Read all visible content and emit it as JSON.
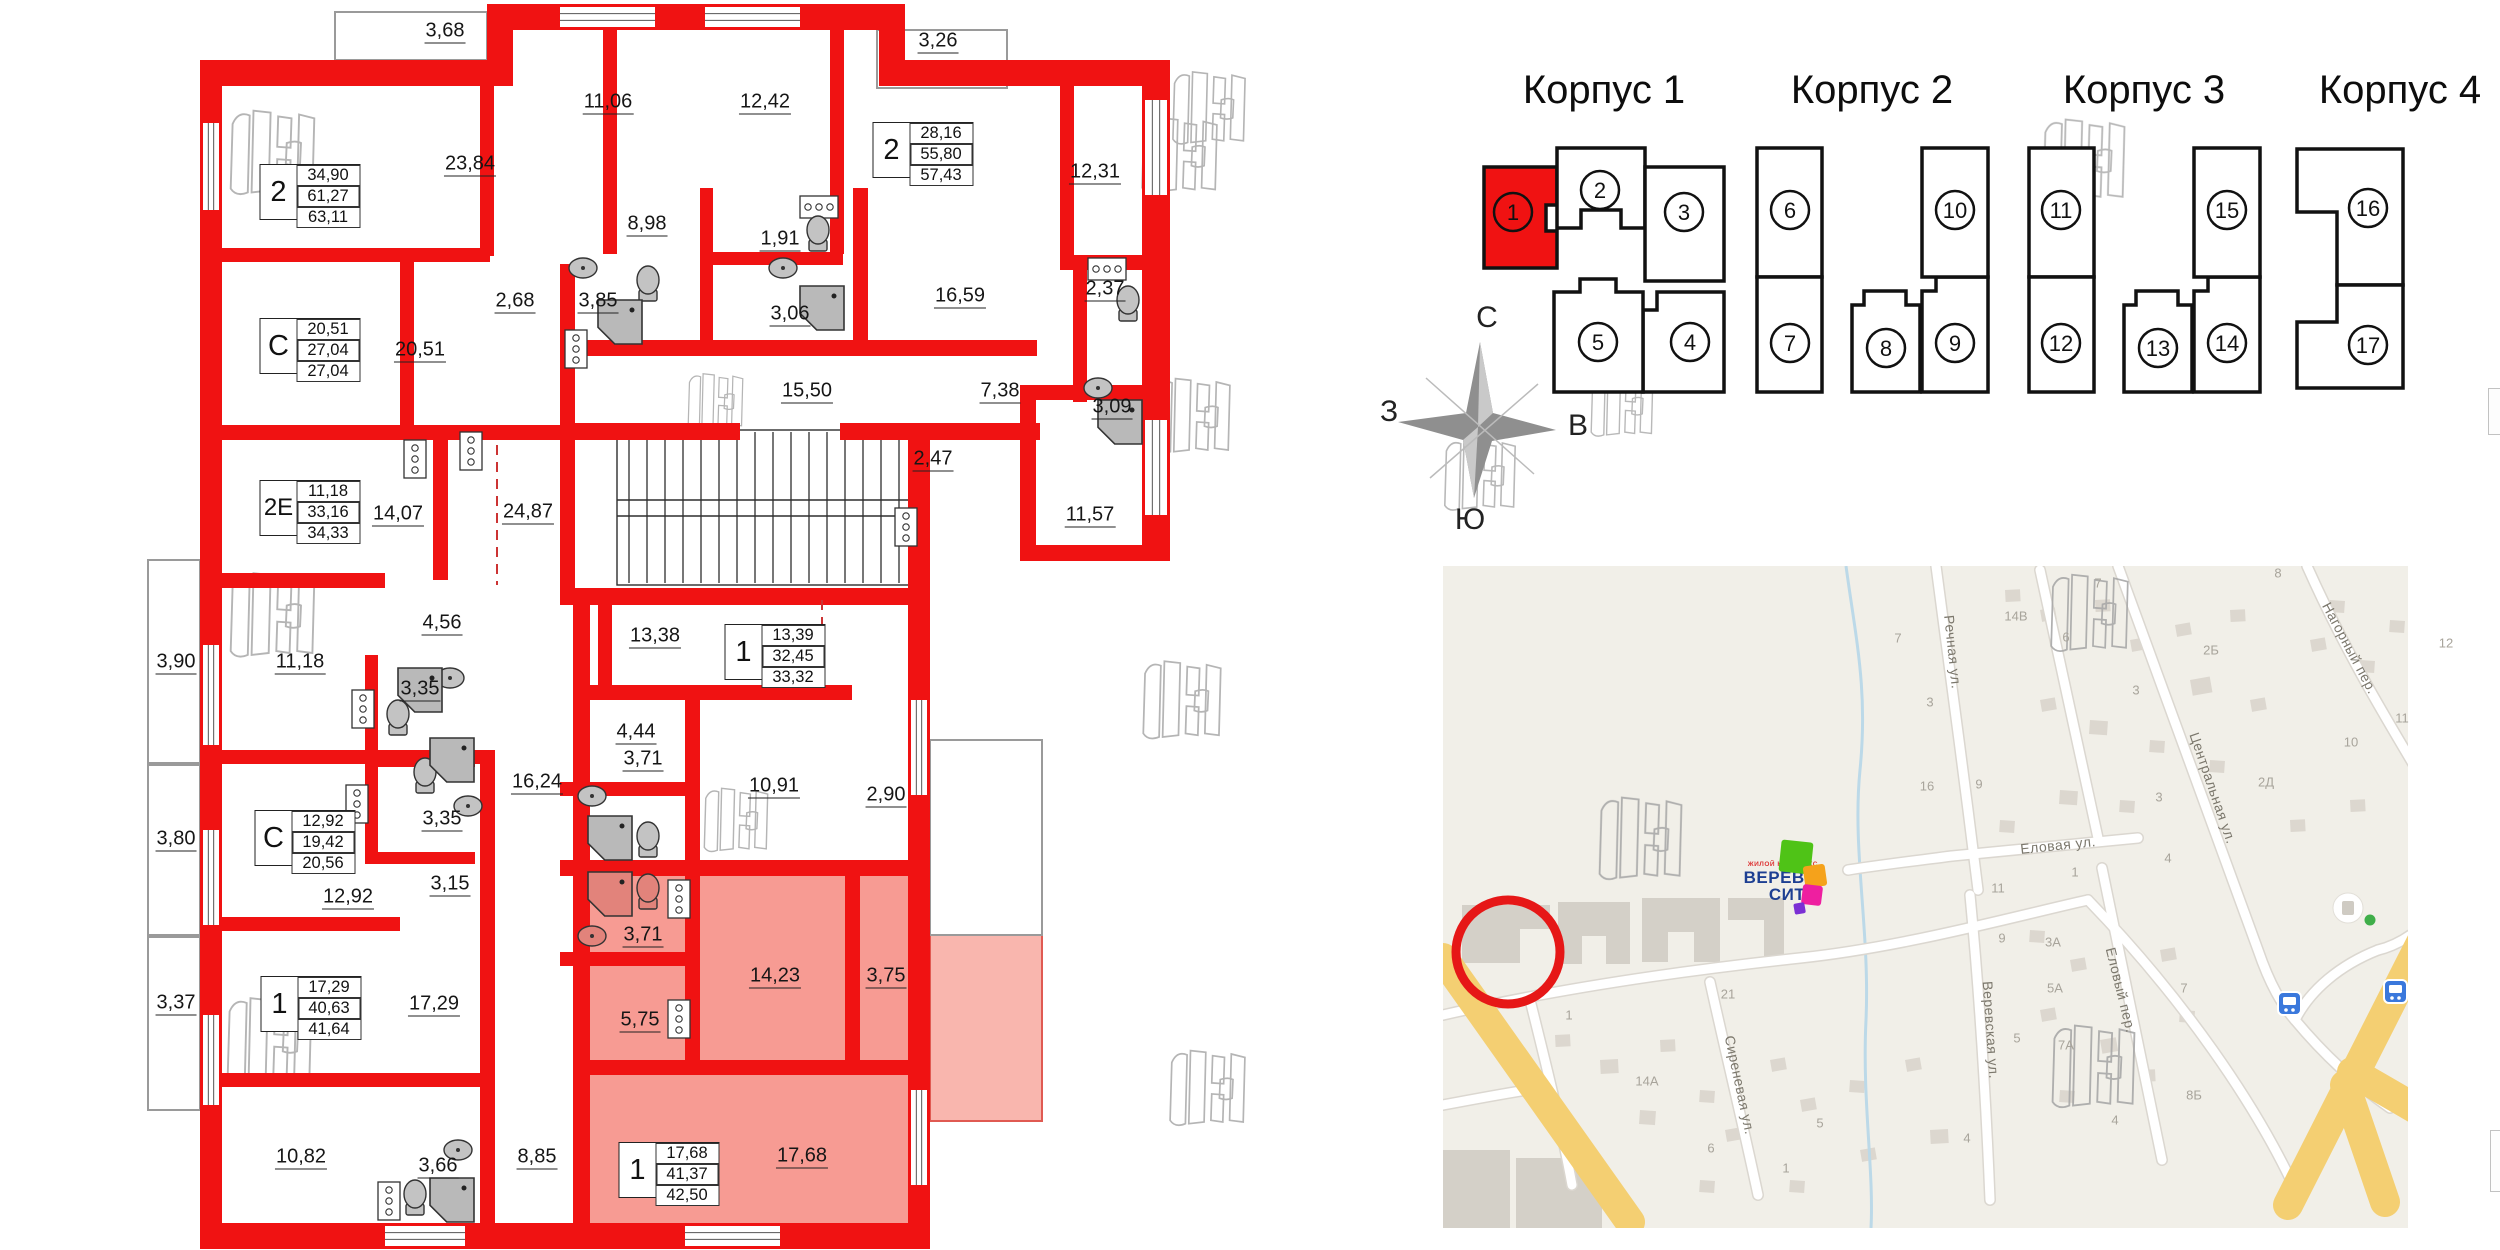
{
  "colors": {
    "wall_red": "#f01212",
    "highlight_pink": "#f79b93",
    "map_bg": "#f1efe8",
    "road_yellow": "#f4cf72",
    "accent_blue": "#3a78dc",
    "circle_red": "#e61717"
  },
  "floorplan": {
    "room_labels": [
      {
        "text": "3,68",
        "x": 445,
        "y": 32
      },
      {
        "text": "23,84",
        "x": 470,
        "y": 165
      },
      {
        "text": "11,06",
        "x": 608,
        "y": 103
      },
      {
        "text": "12,42",
        "x": 765,
        "y": 103
      },
      {
        "text": "3,26",
        "x": 938,
        "y": 42
      },
      {
        "text": "12,31",
        "x": 1095,
        "y": 173
      },
      {
        "text": "8,98",
        "x": 647,
        "y": 225
      },
      {
        "text": "1,91",
        "x": 780,
        "y": 240
      },
      {
        "text": "16,59",
        "x": 960,
        "y": 297
      },
      {
        "text": "2,68",
        "x": 515,
        "y": 302
      },
      {
        "text": "3,85",
        "x": 598,
        "y": 302
      },
      {
        "text": "3,06",
        "x": 790,
        "y": 315
      },
      {
        "text": "2,37",
        "x": 1105,
        "y": 290
      },
      {
        "text": "15,50",
        "x": 807,
        "y": 392
      },
      {
        "text": "7,38",
        "x": 1000,
        "y": 392
      },
      {
        "text": "3,09",
        "x": 1112,
        "y": 408
      },
      {
        "text": "2,47",
        "x": 933,
        "y": 460
      },
      {
        "text": "11,57",
        "x": 1090,
        "y": 516
      },
      {
        "text": "20,51",
        "x": 420,
        "y": 351
      },
      {
        "text": "14,07",
        "x": 398,
        "y": 515
      },
      {
        "text": "24,87",
        "x": 528,
        "y": 513
      },
      {
        "text": "4,56",
        "x": 442,
        "y": 624
      },
      {
        "text": "3,90",
        "x": 176,
        "y": 663
      },
      {
        "text": "11,18",
        "x": 300,
        "y": 663
      },
      {
        "text": "3,35",
        "x": 420,
        "y": 690
      },
      {
        "text": "16,24",
        "x": 537,
        "y": 783
      },
      {
        "text": "3,35",
        "x": 442,
        "y": 820
      },
      {
        "text": "3,80",
        "x": 176,
        "y": 840
      },
      {
        "text": "12,92",
        "x": 348,
        "y": 898
      },
      {
        "text": "3,15",
        "x": 450,
        "y": 885
      },
      {
        "text": "13,38",
        "x": 655,
        "y": 637
      },
      {
        "text": "4,44",
        "x": 636,
        "y": 733
      },
      {
        "text": "10,91",
        "x": 774,
        "y": 787
      },
      {
        "text": "2,90",
        "x": 886,
        "y": 796
      },
      {
        "text": "3,71",
        "x": 643,
        "y": 760
      },
      {
        "text": "3,71",
        "x": 643,
        "y": 936
      },
      {
        "text": "14,23",
        "x": 775,
        "y": 977
      },
      {
        "text": "3,75",
        "x": 886,
        "y": 977
      },
      {
        "text": "5,75",
        "x": 640,
        "y": 1021
      },
      {
        "text": "17,68",
        "x": 802,
        "y": 1157
      },
      {
        "text": "3,37",
        "x": 176,
        "y": 1004
      },
      {
        "text": "17,29",
        "x": 434,
        "y": 1005
      },
      {
        "text": "10,82",
        "x": 301,
        "y": 1158
      },
      {
        "text": "3,66",
        "x": 438,
        "y": 1167
      },
      {
        "text": "8,85",
        "x": 537,
        "y": 1158
      }
    ],
    "stat_boxes": [
      {
        "type": "2",
        "values": [
          "34,90",
          "61,27",
          "63,11"
        ],
        "x": 310,
        "y": 192
      },
      {
        "type": "2",
        "values": [
          "28,16",
          "55,80",
          "57,43"
        ],
        "x": 923,
        "y": 150
      },
      {
        "type": "С",
        "values": [
          "20,51",
          "27,04",
          "27,04"
        ],
        "x": 310,
        "y": 346
      },
      {
        "type": "2Е",
        "values": [
          "11,18",
          "33,16",
          "34,33"
        ],
        "x": 310,
        "y": 508
      },
      {
        "type": "С",
        "values": [
          "12,92",
          "19,42",
          "20,56"
        ],
        "x": 305,
        "y": 838
      },
      {
        "type": "1",
        "values": [
          "13,39",
          "32,45",
          "33,32"
        ],
        "x": 775,
        "y": 652
      },
      {
        "type": "1",
        "values": [
          "17,29",
          "40,63",
          "41,64"
        ],
        "x": 311,
        "y": 1004
      },
      {
        "type": "1",
        "values": [
          "17,68",
          "41,37",
          "42,50"
        ],
        "x": 669,
        "y": 1170,
        "highlighted": true
      }
    ]
  },
  "buildings": {
    "groups": [
      {
        "title": "Корпус 1",
        "cx": 1604,
        "sections": [
          {
            "num": "1",
            "selected": true
          },
          {
            "num": "2"
          },
          {
            "num": "3"
          },
          {
            "num": "4"
          },
          {
            "num": "5"
          }
        ]
      },
      {
        "title": "Корпус 2",
        "cx": 1872,
        "sections": [
          {
            "num": "6"
          },
          {
            "num": "7"
          },
          {
            "num": "8"
          },
          {
            "num": "9"
          },
          {
            "num": "10"
          }
        ]
      },
      {
        "title": "Корпус 3",
        "cx": 2144,
        "sections": [
          {
            "num": "11"
          },
          {
            "num": "12"
          },
          {
            "num": "13"
          },
          {
            "num": "14"
          },
          {
            "num": "15"
          }
        ]
      },
      {
        "title": "Корпус 4",
        "cx": 2400,
        "sections": [
          {
            "num": "16"
          },
          {
            "num": "17"
          }
        ]
      }
    ]
  },
  "compass": {
    "north": "С",
    "south": "Ю",
    "west": "З",
    "east": "В"
  },
  "map": {
    "logo": {
      "line1": "ЖИЛОЙ КОМПЛЕКС",
      "line2": "ВЕРЕВО",
      "line3": "СИТИ"
    },
    "streets": [
      {
        "name": "Речная ул.",
        "x": 1953,
        "y": 652,
        "rot": 84
      },
      {
        "name": "Центральная ул.",
        "x": 2213,
        "y": 788,
        "rot": 71
      },
      {
        "name": "Нагорный пер.",
        "x": 2350,
        "y": 648,
        "rot": 62
      },
      {
        "name": "Еловая ул.",
        "x": 2058,
        "y": 845,
        "rot": -6
      },
      {
        "name": "Сиреневая ул.",
        "x": 1740,
        "y": 1085,
        "rot": 78
      },
      {
        "name": "Веревская ул.",
        "x": 1991,
        "y": 1030,
        "rot": 86
      },
      {
        "name": "Еловый пер.",
        "x": 2121,
        "y": 990,
        "rot": 76
      }
    ],
    "house_numbers": [
      {
        "t": "7",
        "x": 1898,
        "y": 638
      },
      {
        "t": "3",
        "x": 1930,
        "y": 702
      },
      {
        "t": "16",
        "x": 1927,
        "y": 786
      },
      {
        "t": "9",
        "x": 1979,
        "y": 784
      },
      {
        "t": "14В",
        "x": 2016,
        "y": 616
      },
      {
        "t": "6",
        "x": 2066,
        "y": 637
      },
      {
        "t": "7",
        "x": 2098,
        "y": 583
      },
      {
        "t": "3",
        "x": 2136,
        "y": 690
      },
      {
        "t": "2Б",
        "x": 2211,
        "y": 650
      },
      {
        "t": "8",
        "x": 2278,
        "y": 573
      },
      {
        "t": "12",
        "x": 2446,
        "y": 643
      },
      {
        "t": "11",
        "x": 2402,
        "y": 718
      },
      {
        "t": "10",
        "x": 2351,
        "y": 742
      },
      {
        "t": "2Д",
        "x": 2266,
        "y": 782
      },
      {
        "t": "3",
        "x": 2159,
        "y": 797
      },
      {
        "t": "1",
        "x": 2075,
        "y": 872
      },
      {
        "t": "4",
        "x": 2168,
        "y": 858
      },
      {
        "t": "11",
        "x": 1998,
        "y": 888
      },
      {
        "t": "21",
        "x": 1728,
        "y": 994
      },
      {
        "t": "1",
        "x": 1569,
        "y": 1015
      },
      {
        "t": "14А",
        "x": 1647,
        "y": 1081
      },
      {
        "t": "6",
        "x": 1711,
        "y": 1148
      },
      {
        "t": "5",
        "x": 1820,
        "y": 1123
      },
      {
        "t": "4",
        "x": 1967,
        "y": 1138
      },
      {
        "t": "1",
        "x": 1786,
        "y": 1168
      },
      {
        "t": "9",
        "x": 2002,
        "y": 938
      },
      {
        "t": "3А",
        "x": 2053,
        "y": 942
      },
      {
        "t": "5А",
        "x": 2055,
        "y": 988
      },
      {
        "t": "5",
        "x": 2017,
        "y": 1038
      },
      {
        "t": "7А",
        "x": 2066,
        "y": 1045
      },
      {
        "t": "7",
        "x": 2184,
        "y": 988
      },
      {
        "t": "8Б",
        "x": 2194,
        "y": 1095
      },
      {
        "t": "4",
        "x": 2115,
        "y": 1120
      }
    ]
  }
}
